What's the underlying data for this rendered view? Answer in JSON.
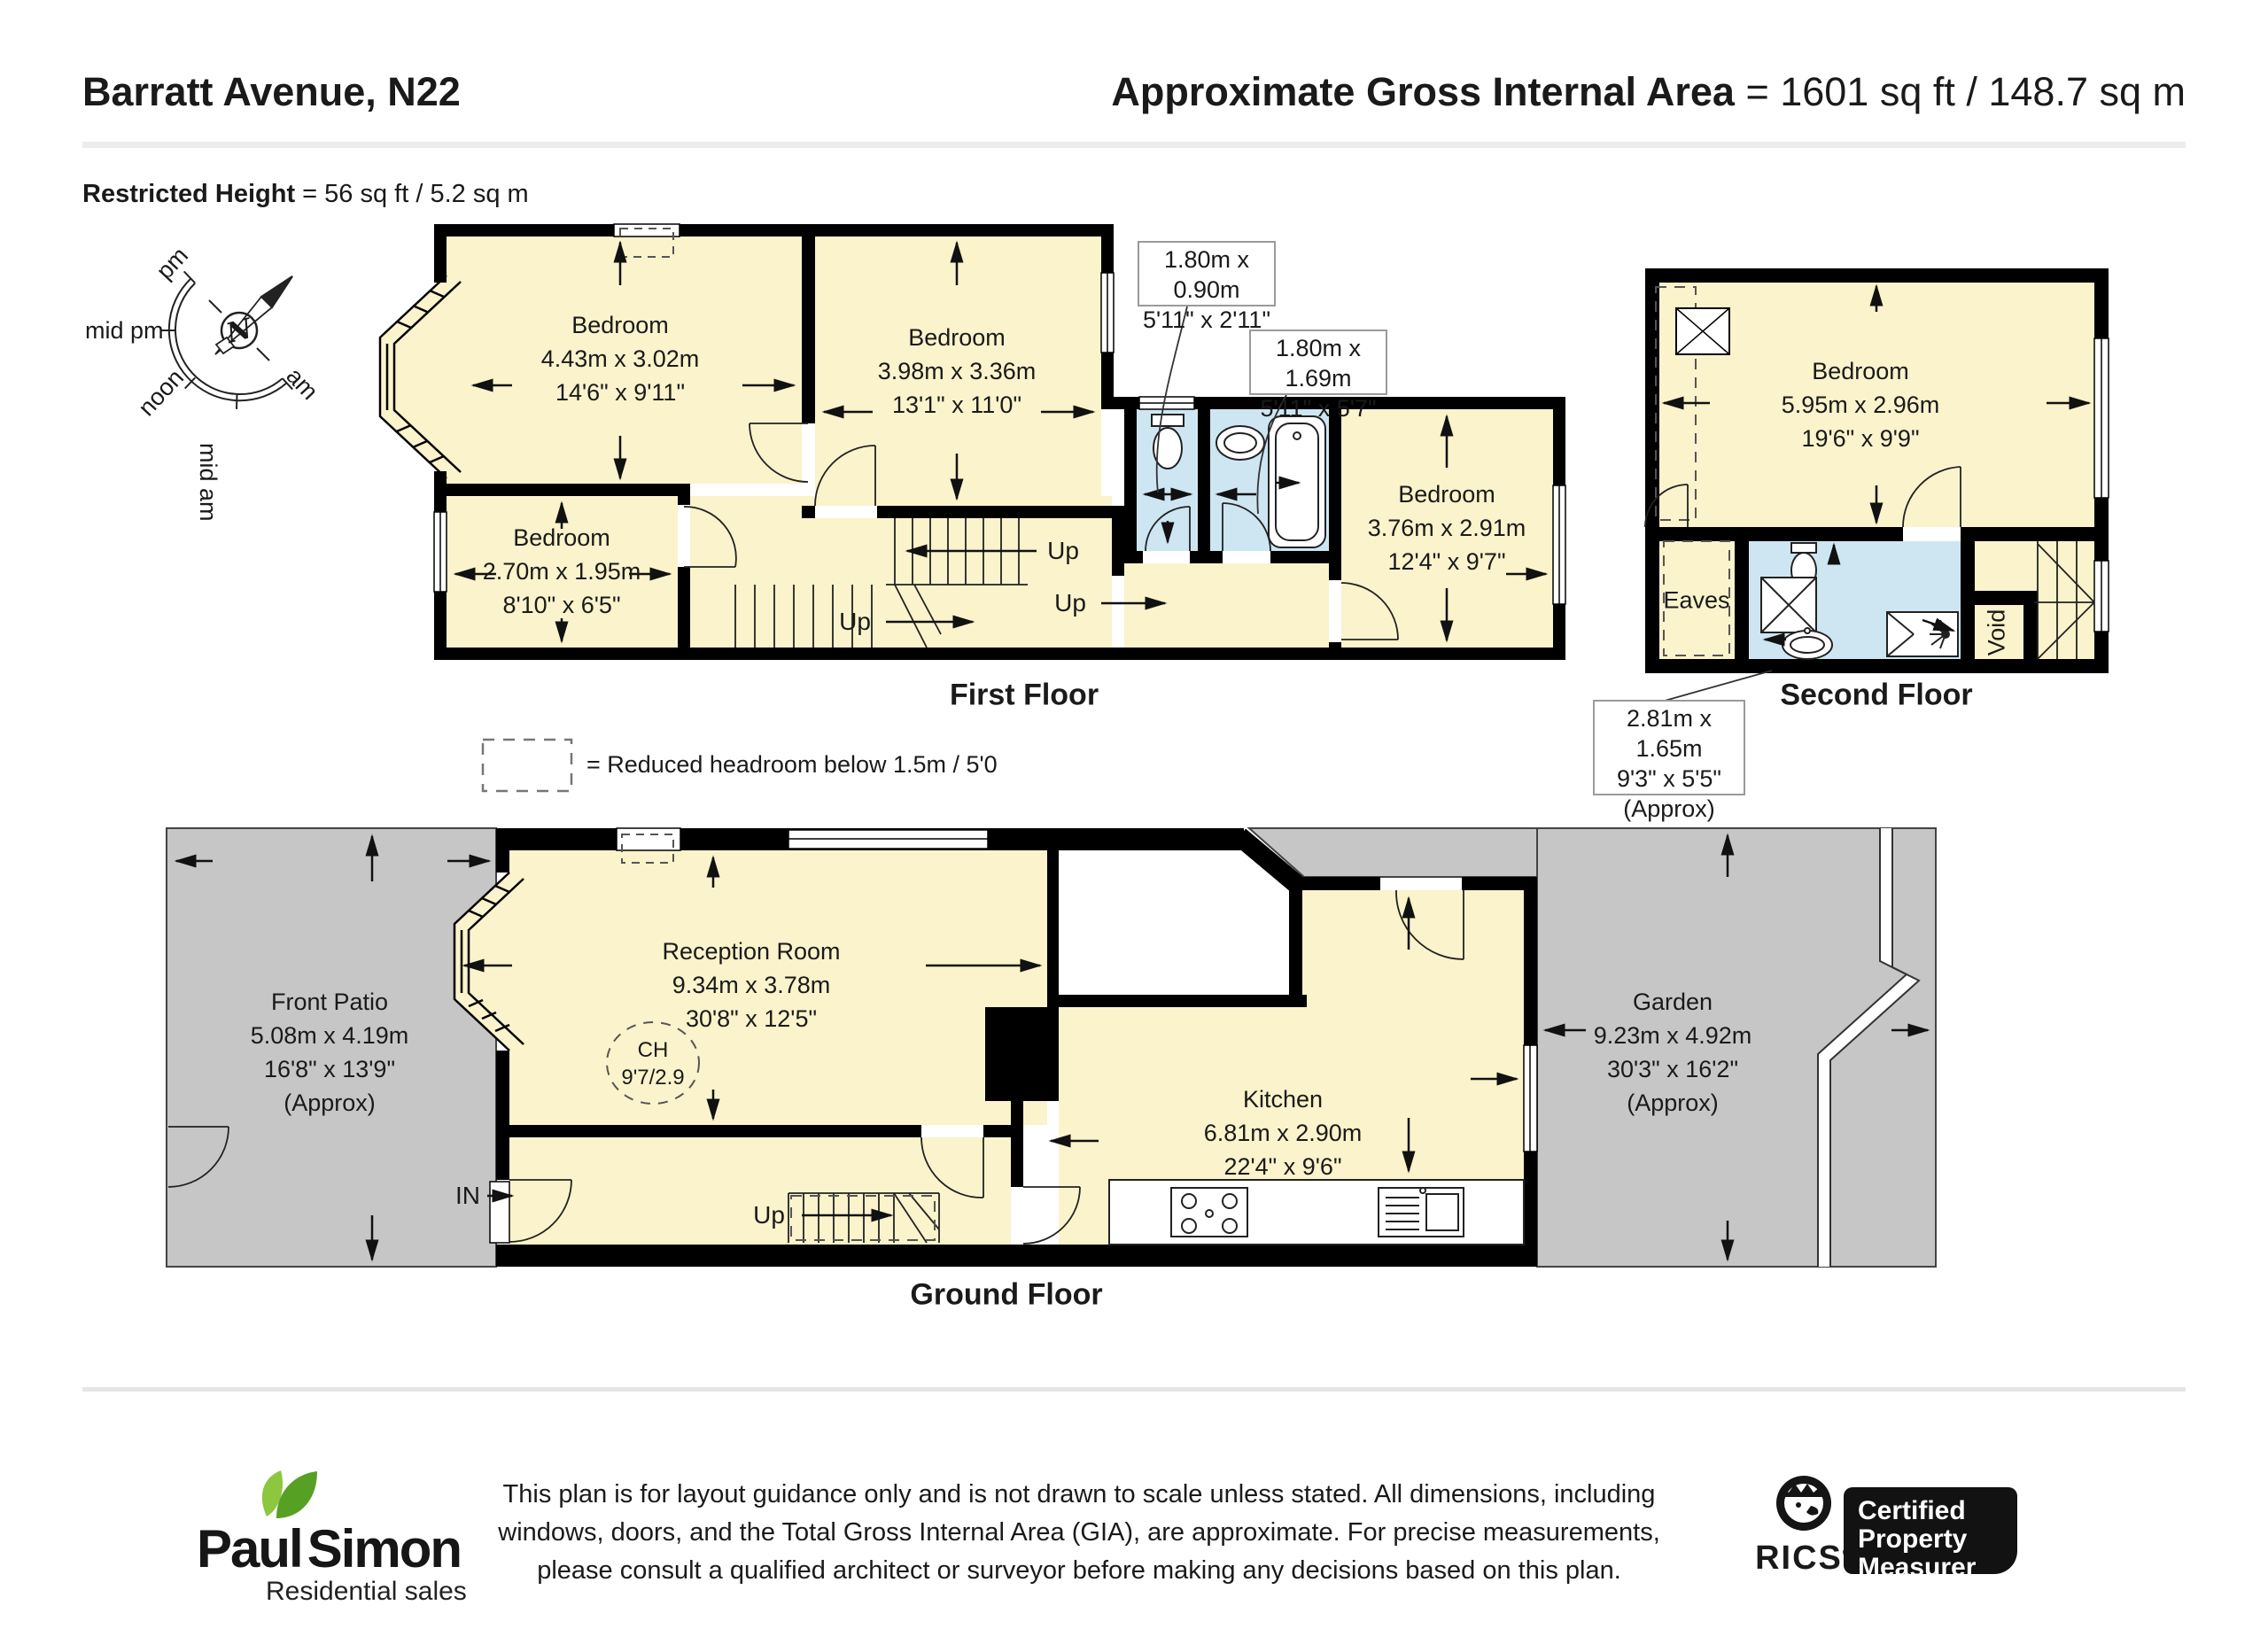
{
  "header": {
    "address": "Barratt Avenue, N22",
    "gia_label": "Approximate Gross Internal Area",
    "gia_value": " = 1601 sq ft / 148.7 sq m",
    "restricted_label": "Restricted Height",
    "restricted_value": " = 56 sq ft / 5.2 sq m"
  },
  "compass": {
    "north": "N",
    "sun_labels": [
      "pm",
      "mid pm",
      "noon",
      "mid am",
      "am"
    ]
  },
  "legend": {
    "text": "= Reduced headroom below 1.5m / 5'0"
  },
  "floors": {
    "first": {
      "caption": "First Floor",
      "up_label": "Up",
      "rooms": [
        {
          "name": "Bedroom",
          "metric": "4.43m x 3.02m",
          "imperial": "14'6\" x 9'11\""
        },
        {
          "name": "Bedroom",
          "metric": "3.98m x 3.36m",
          "imperial": "13'1\" x 11'0\""
        },
        {
          "name": "Bedroom",
          "metric": "2.70m x 1.95m",
          "imperial": "8'10\" x 6'5\""
        },
        {
          "name": "Bedroom",
          "metric": "3.76m x 2.91m",
          "imperial": "12'4\" x 9'7\""
        }
      ],
      "callouts": [
        {
          "metric": "1.80m x 0.90m",
          "imperial": "5'11\" x 2'11\""
        },
        {
          "metric": "1.80m x 1.69m",
          "imperial": "5'11\" x 5'7\""
        }
      ]
    },
    "second": {
      "caption": "Second Floor",
      "bedroom": {
        "name": "Bedroom",
        "metric": "5.95m x 2.96m",
        "imperial": "19'6\" x 9'9\""
      },
      "eaves_label": "Eaves",
      "void_label": "Void",
      "callout": {
        "metric": "2.81m x 1.65m",
        "imperial": "9'3\" x 5'5\"",
        "note": "(Approx)"
      }
    },
    "ground": {
      "caption": "Ground Floor",
      "in_label": "IN",
      "up_label": "Up",
      "front_patio": {
        "name": "Front Patio",
        "metric": "5.08m x 4.19m",
        "imperial": "16'8\" x 13'9\"",
        "note": "(Approx)"
      },
      "reception": {
        "name": "Reception Room",
        "metric": "9.34m x 3.78m",
        "imperial": "30'8\" x 12'5\""
      },
      "ceiling_height": {
        "line1": "CH",
        "line2": "9'7/2.9"
      },
      "kitchen": {
        "name": "Kitchen",
        "metric": "6.81m x 2.90m",
        "imperial": "22'4\" x 9'6\""
      },
      "garden": {
        "name": "Garden",
        "metric": "9.23m x 4.92m",
        "imperial": "30'3\" x 16'2\"",
        "note": "(Approx)"
      }
    }
  },
  "footer": {
    "disclaimer_lines": [
      "This plan is for layout guidance only and is not drawn to scale unless stated. All dimensions, including",
      "windows, doors, and the Total Gross Internal Area (GIA), are approximate. For precise measurements,",
      "please consult a qualified architect or surveyor before making any decisions based on this plan."
    ],
    "brand": {
      "first": "Paul",
      "second": "Simon",
      "tagline": "Residential sales"
    },
    "rics": {
      "name": "RICS",
      "reg": "®",
      "badge_lines": [
        "Certified",
        "Property",
        "Measurer"
      ]
    }
  },
  "colors": {
    "room_fill": "#faf3cb",
    "wet_room_fill": "#cde6f2",
    "outdoor_fill": "#c6c6c6",
    "wall": "#000000",
    "leaf_light": "#8dc63f",
    "leaf_dark": "#56a024"
  }
}
